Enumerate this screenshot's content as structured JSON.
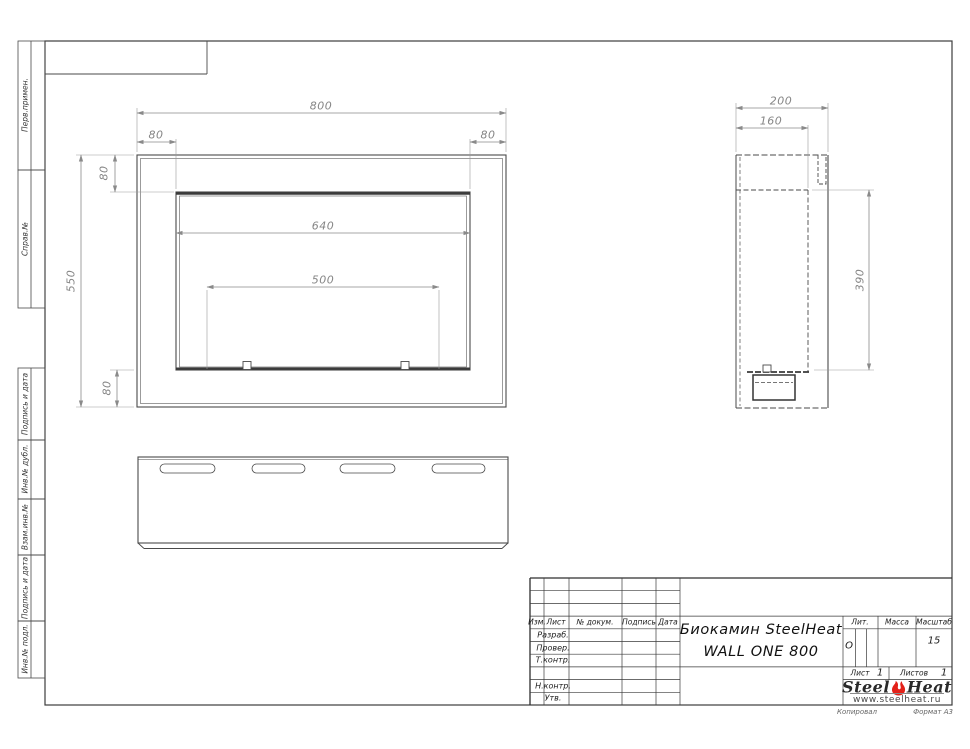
{
  "page": {
    "footer_left": "Копировал",
    "footer_right": "Формат А3"
  },
  "margin_blocks": [
    {
      "label": "Перв.примен."
    },
    {
      "label": "Справ.№"
    },
    {
      "label": "Подпись и дата"
    },
    {
      "label": "Инв.№ дубл."
    },
    {
      "label": "Взам.инв.№"
    },
    {
      "label": "Подпись и дата"
    },
    {
      "label": "Инв.№ подл."
    }
  ],
  "dimensions": {
    "front_width": "800",
    "front_flange_left": "80",
    "front_flange_right": "80",
    "front_flange_top": "80",
    "front_opening_width": "640",
    "front_burner_width": "500",
    "front_height": "550",
    "front_flange_bottom": "80",
    "side_depth": "200",
    "side_inner_depth": "160",
    "side_opening_height": "390"
  },
  "title_block": {
    "cols": {
      "izm": "Изм.",
      "sheet": "Лист",
      "doc": "№ докум.",
      "sign": "Подпись",
      "date": "Дата"
    },
    "roles": {
      "developed": "Разраб.",
      "checked": "Провер.",
      "tcontrol": "Т.контр.",
      "ncontrol": "Н.контр.",
      "approved": "Утв."
    },
    "title_line1": "Биокамин SteelHeat",
    "title_line2": "WALL ONE 800",
    "lit_label": "Лит.",
    "lit_value": "О",
    "mass_label": "Масса",
    "scale_label": "Масштаб",
    "scale_value": "15",
    "sheet_label": "Лист",
    "sheet_value": "1",
    "sheets_label": "Листов",
    "sheets_value": "1",
    "logo": {
      "part1": "Steel",
      "part2": "Heat",
      "url": "www.steelheat.ru",
      "flame_color": "#e32119"
    }
  }
}
